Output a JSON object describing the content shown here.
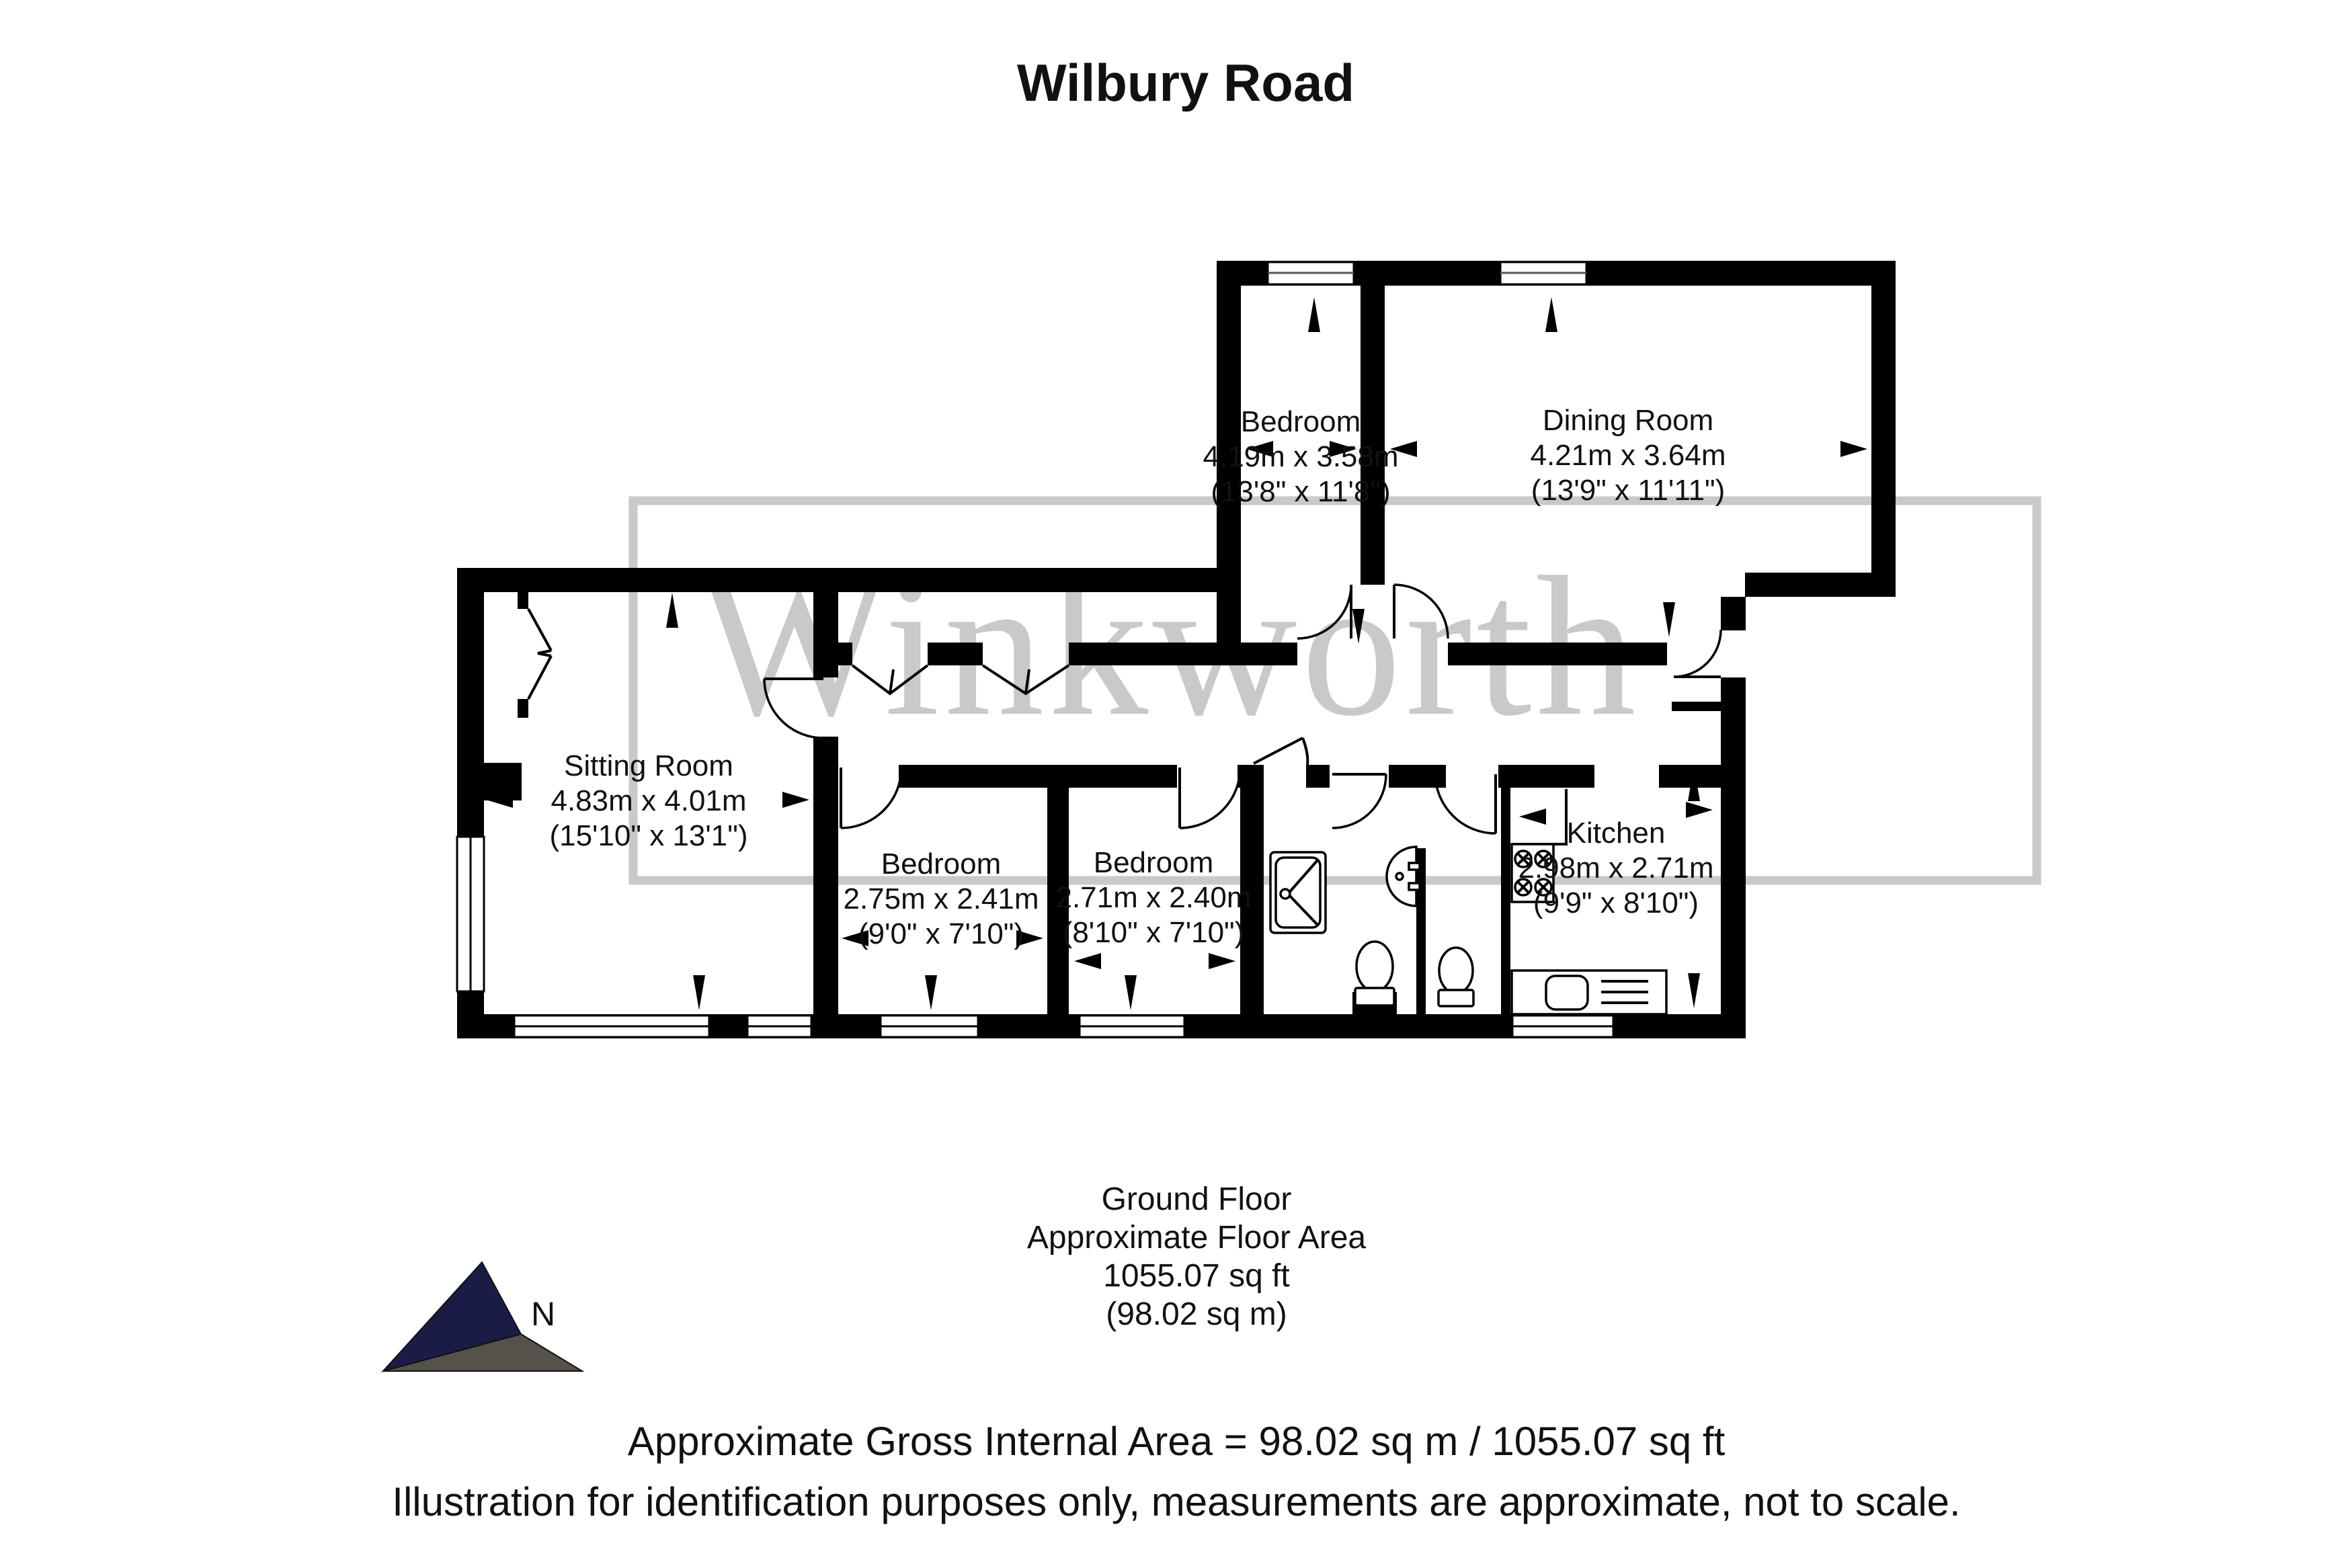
{
  "title": "Wilbury Road",
  "watermark": {
    "text": "Winkworth",
    "color": "#c9c9c9"
  },
  "compass": {
    "label": "N",
    "navy_color": "#1b1c45",
    "gray_color": "#55524b"
  },
  "rooms": [
    {
      "name": "Bedroom",
      "metric": "4.19m x 3.58m",
      "imperial": "(13'8\" x 11'8\")"
    },
    {
      "name": "Dining Room",
      "metric": "4.21m x 3.64m",
      "imperial": "(13'9\" x 11'11\")"
    },
    {
      "name": "Sitting Room",
      "metric": "4.83m x 4.01m",
      "imperial": "(15'10\" x 13'1\")"
    },
    {
      "name": "Bedroom",
      "metric": "2.75m x 2.41m",
      "imperial": "(9'0\" x 7'10\")"
    },
    {
      "name": "Bedroom",
      "metric": "2.71m x 2.40m",
      "imperial": "(8'10\" x 7'10\")"
    },
    {
      "name": "Kitchen",
      "metric": "2.98m x 2.71m",
      "imperial": "(9'9\" x 8'10\")"
    }
  ],
  "floor_summary": {
    "line1": "Ground Floor",
    "line2": "Approximate Floor Area",
    "line3": "1055.07 sq ft",
    "line4": "(98.02 sq m)"
  },
  "footer": {
    "line1": "Approximate Gross Internal Area = 98.02 sq m / 1055.07 sq ft",
    "line2": "Illustration for identification purposes only, measurements are approximate, not to scale."
  },
  "colors": {
    "walls": "#000000",
    "watermark": "#c9c9c9",
    "text": "#111111"
  }
}
